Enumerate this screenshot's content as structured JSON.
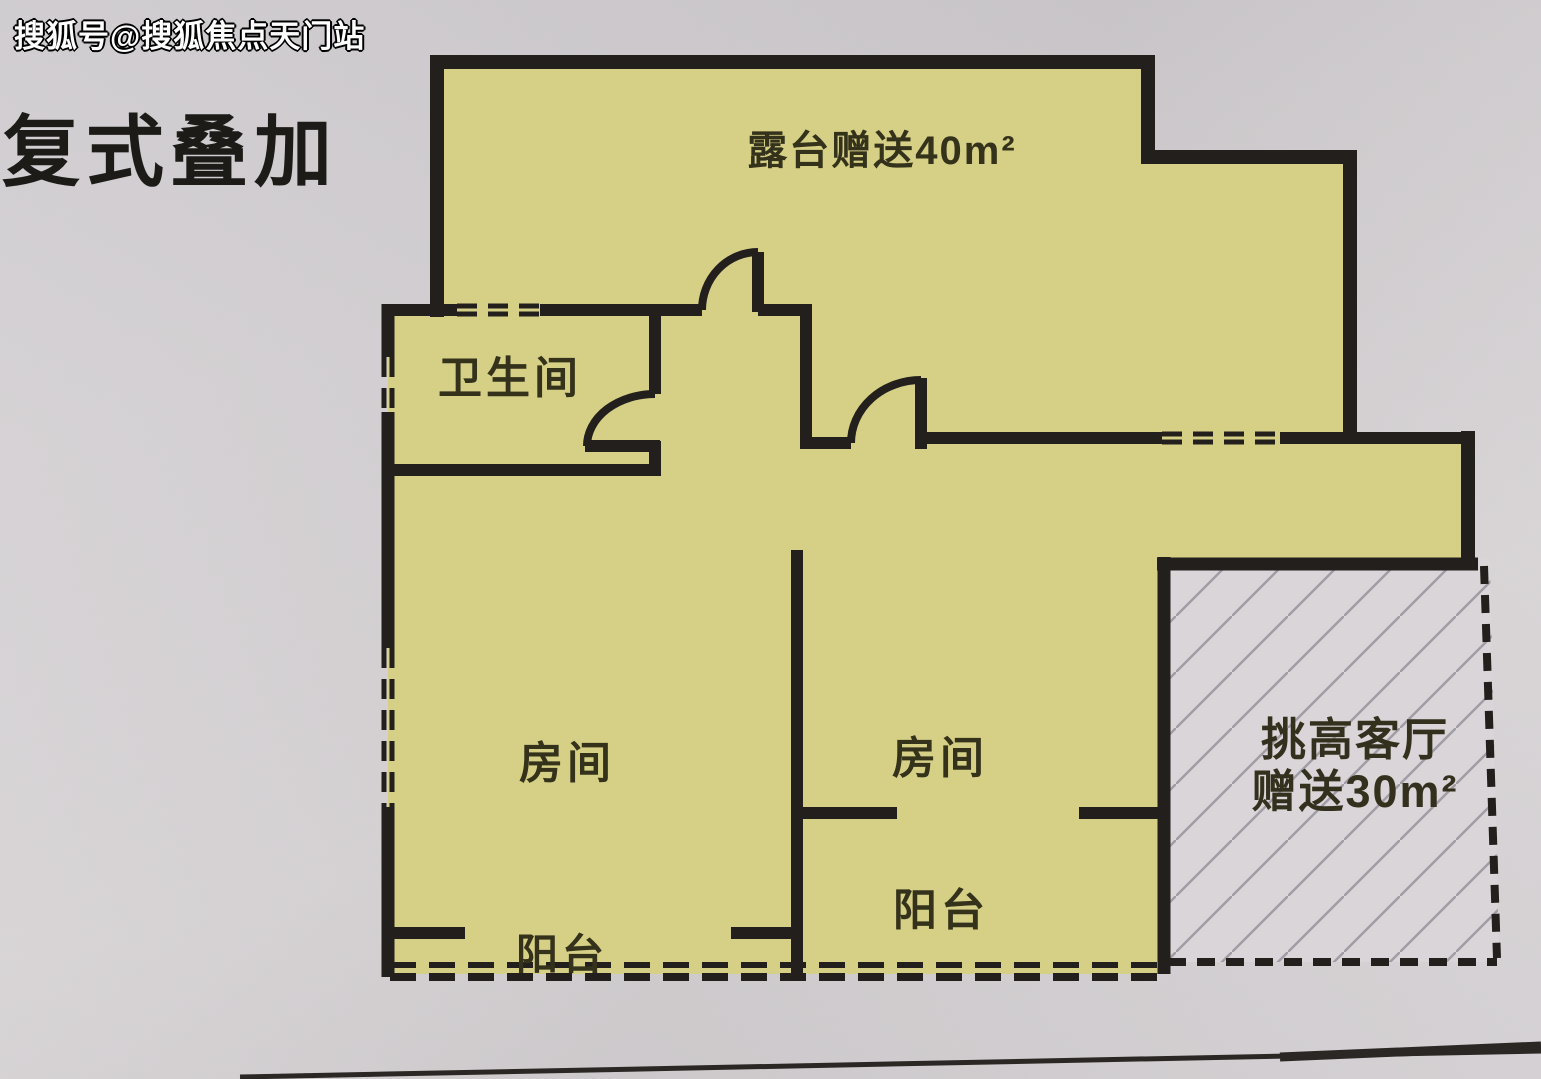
{
  "watermark": {
    "text": "搜狐号@搜狐焦点天门站"
  },
  "header": {
    "title": "复式叠加"
  },
  "floor_plan": {
    "type": "residential-duplex-floor-plan",
    "rooms": [
      {
        "name": "terrace",
        "label": "露台赠送40m²",
        "bonus_area_sqm": 40
      },
      {
        "name": "bathroom",
        "label": "卫生间"
      },
      {
        "name": "bedroom-left",
        "label": "房间"
      },
      {
        "name": "bedroom-right",
        "label": "房间"
      },
      {
        "name": "balcony-right",
        "label": "阳台"
      },
      {
        "name": "balcony-left",
        "label": "阳台"
      },
      {
        "name": "living-room",
        "label_line1": "挑高客厅",
        "label_line2": "赠送30m²",
        "bonus_area_sqm": 30
      }
    ],
    "colors": {
      "floor_fill": "#d6d086",
      "wall": "#221f1c",
      "paper": "#d4d0d3",
      "hatch_line": "#a19da5"
    }
  }
}
